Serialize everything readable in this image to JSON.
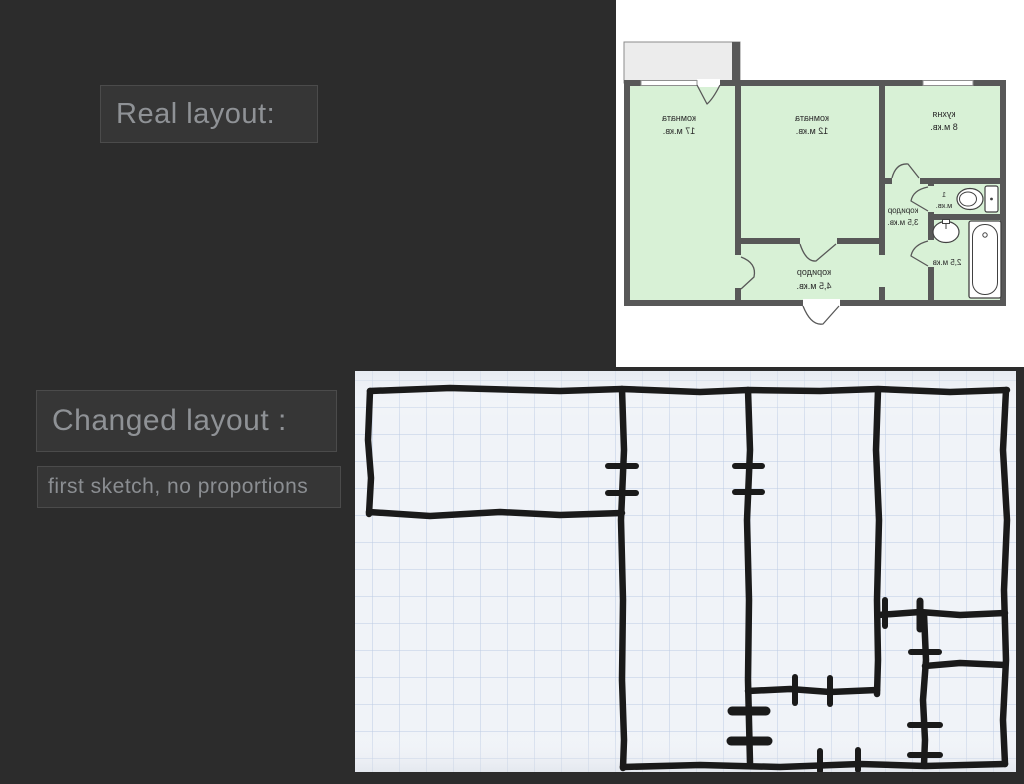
{
  "slide": {
    "background": "#2c2c2c",
    "title_real": "Real layout:",
    "title_changed": "Changed layout :",
    "subtitle": "first sketch, no proportions"
  },
  "floorplan": {
    "colors": {
      "panel": "#ffffff",
      "room": "#d8f1d6",
      "wall": "#585858",
      "balcony": "#ececec",
      "fixture_stroke": "#414141",
      "label": "#2a2a2a"
    },
    "labels": {
      "room17": {
        "l1": "комната",
        "l2": "17 м.кв."
      },
      "room12": {
        "l1": "комната",
        "l2": "12 м.кв."
      },
      "kitchen": {
        "l1": "кухня",
        "l2": "8 м.кв."
      },
      "toilet": {
        "l1": "1",
        "l2": "м.кв."
      },
      "corridor35": {
        "l1": "коридор",
        "l2": "3,5 м.кв."
      },
      "bath": {
        "l1": "2,5 м.кв"
      },
      "corridor45": {
        "l1": "коридор",
        "l2": "4,5 м.кв."
      }
    }
  },
  "sketch": {
    "colors": {
      "paper": "#f0f3f8",
      "grid": "#bccbe3",
      "ink": "#1a1a1a"
    }
  }
}
